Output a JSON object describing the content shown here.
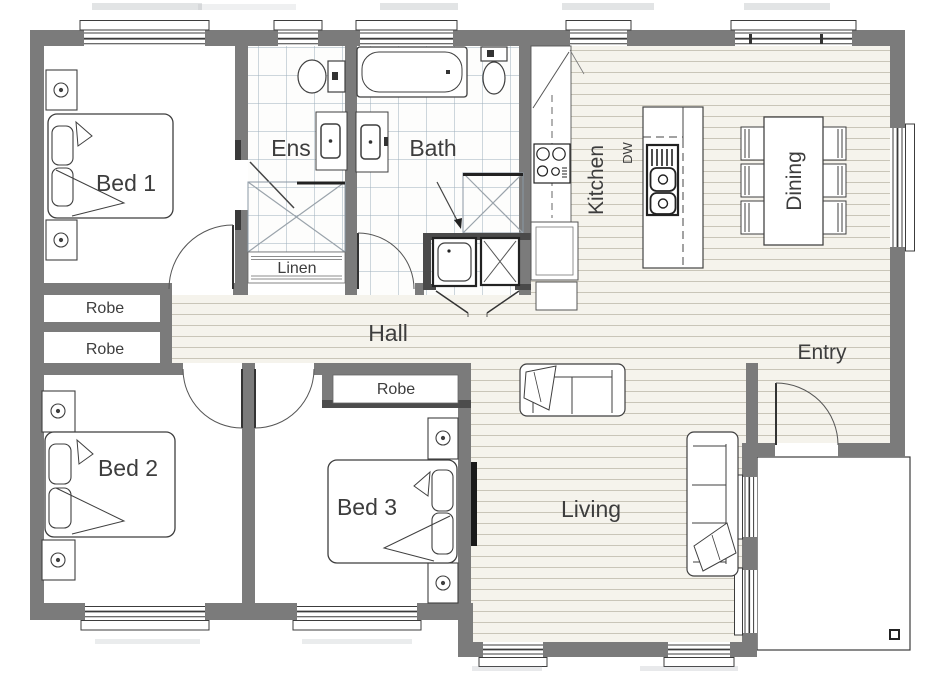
{
  "plan": {
    "type": "floor-plan",
    "labels": {
      "bed1": "Bed 1",
      "bed2": "Bed 2",
      "bed3": "Bed 3",
      "ens": "Ens",
      "bath": "Bath",
      "linen": "Linen",
      "robe1": "Robe",
      "robe2": "Robe",
      "robe3": "Robe",
      "hall": "Hall",
      "entry": "Entry",
      "kitchen": "Kitchen",
      "dining": "Dining",
      "living": "Living",
      "dishwasher": "DW"
    },
    "colors": {
      "wall": "#7b7b7b",
      "floor_background": "#f5f3ec",
      "floorboard_line": "#c9c5b8",
      "tile_line": "#9db0bc",
      "label_text": "#3d3d3d",
      "fixture_outline": "#3f3f3f",
      "door_leaf": "#333333"
    }
  }
}
